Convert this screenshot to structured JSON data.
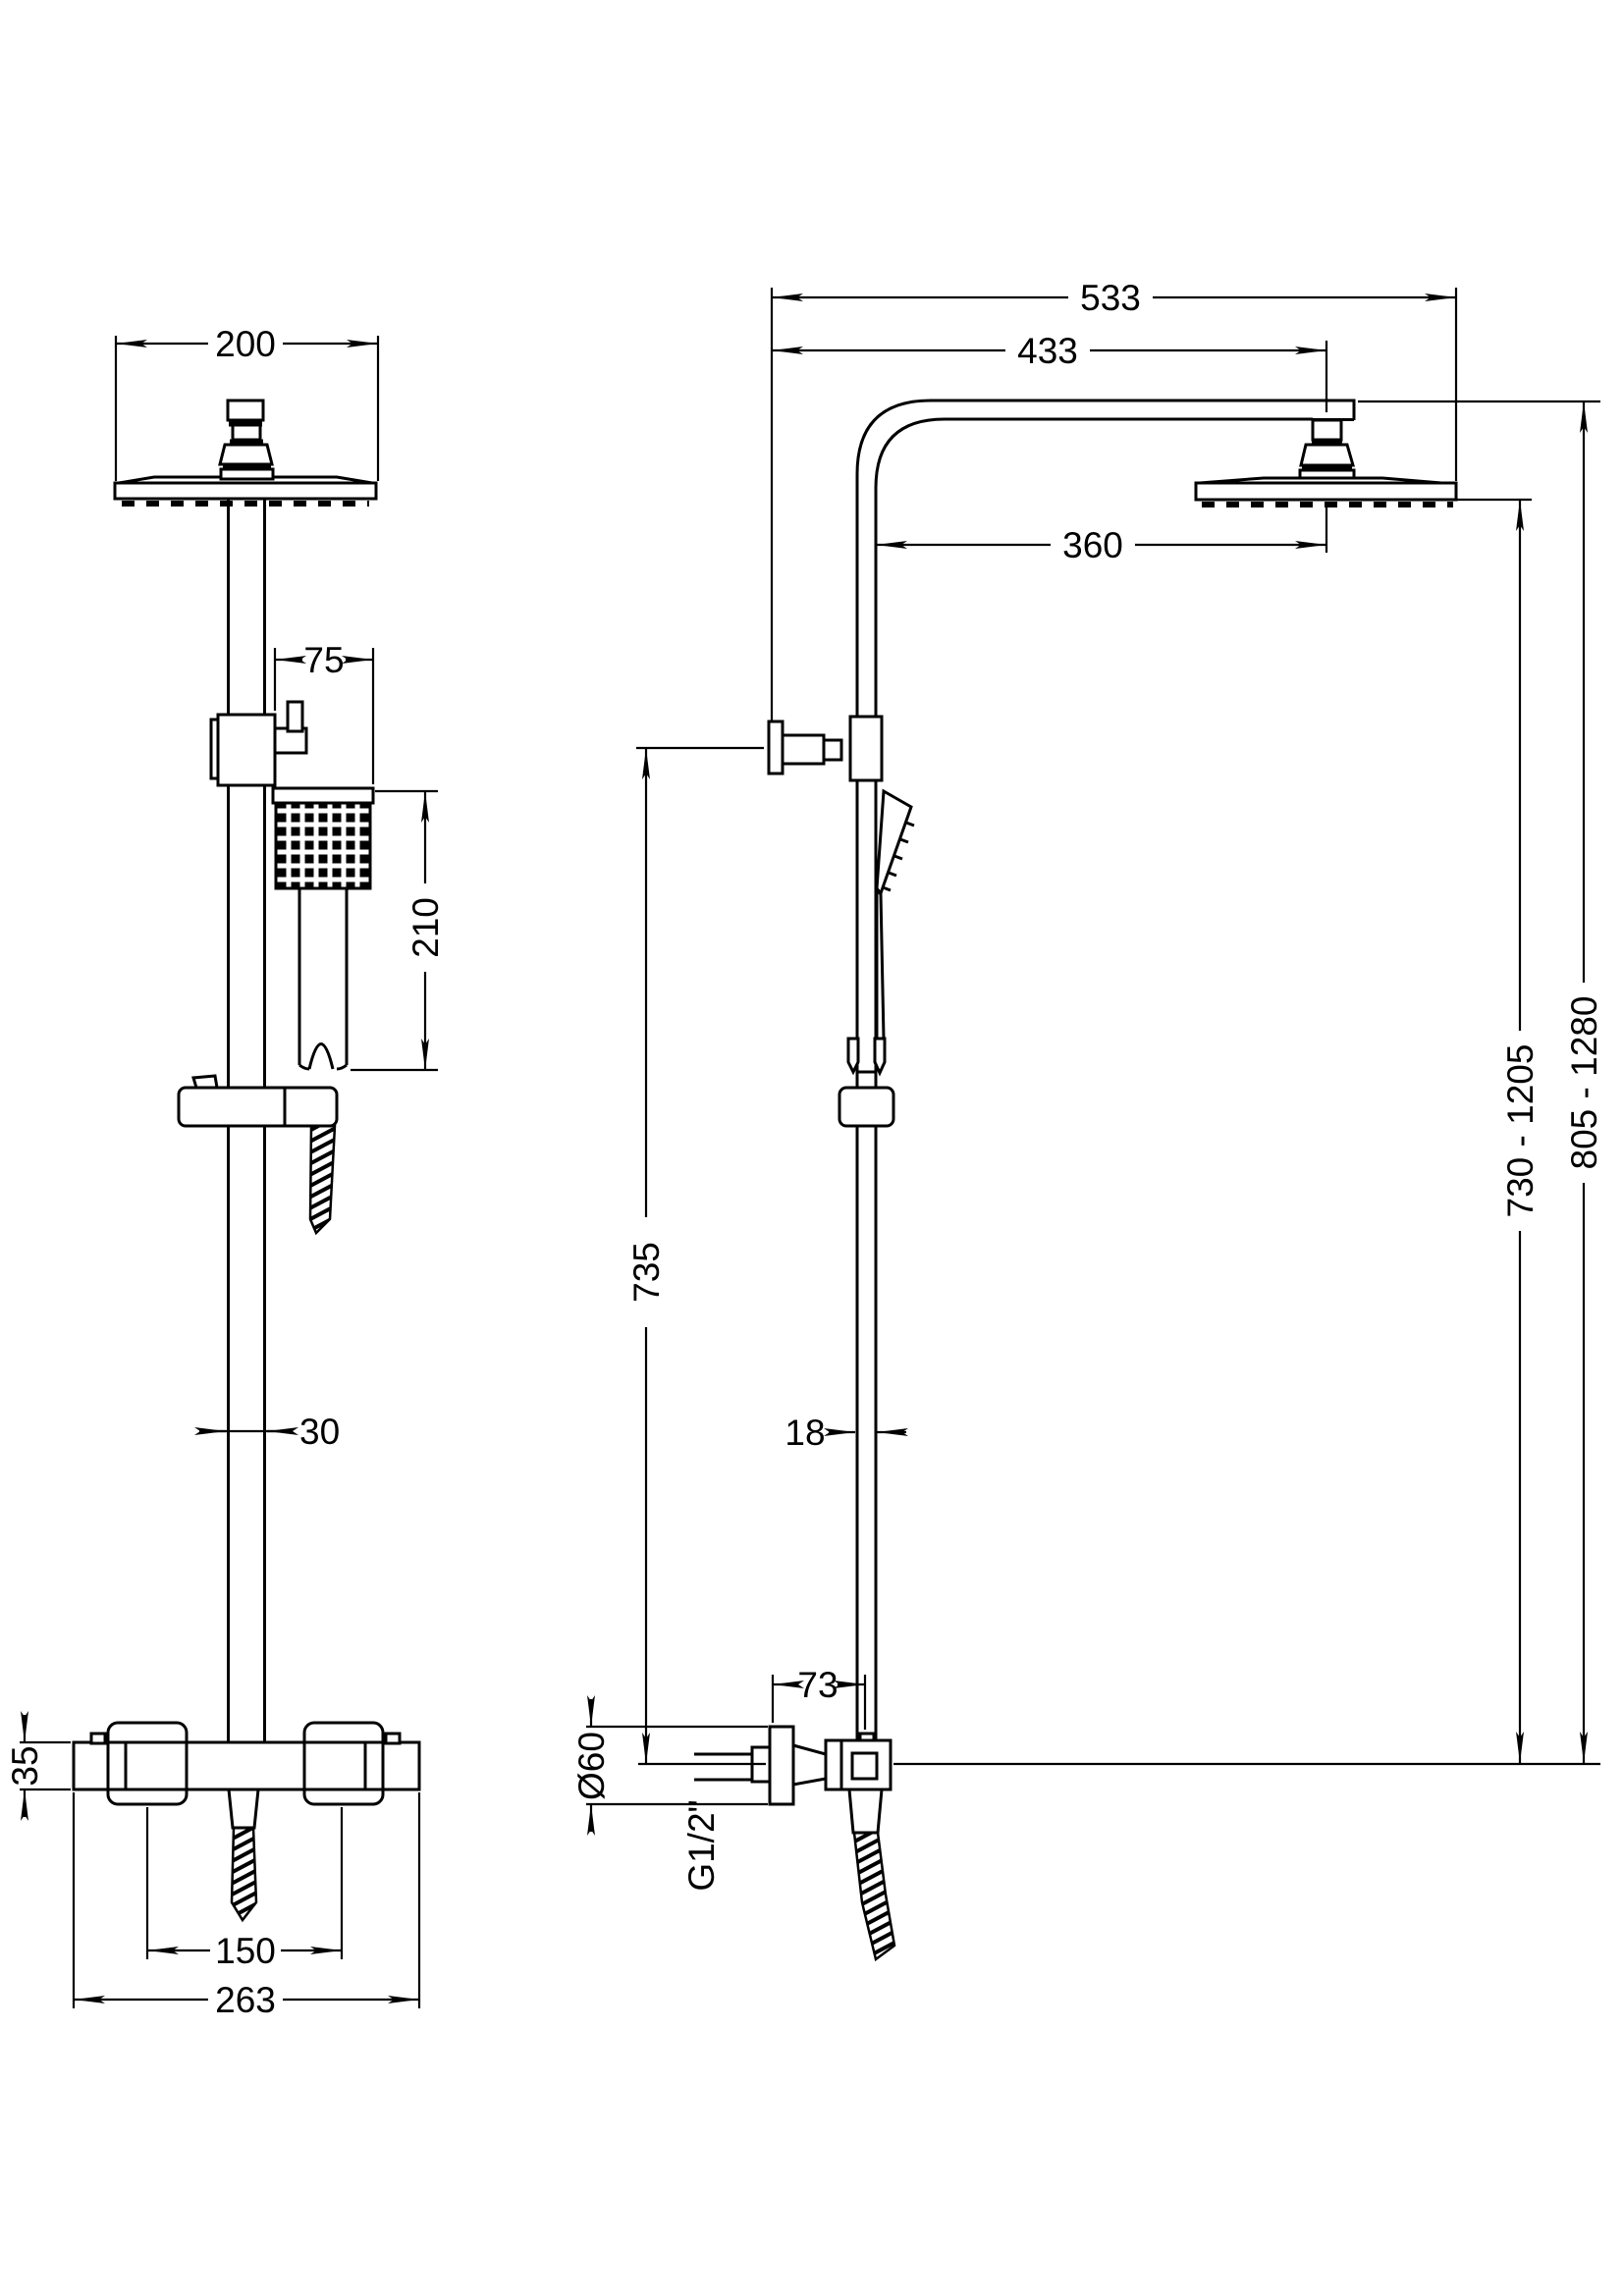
{
  "drawing": {
    "type": "technical-dimension-drawing",
    "subject": "thermostatic shower column with overhead shower, hand shower and bar mixer valve",
    "views": [
      "front elevation",
      "side elevation"
    ],
    "units": "mm",
    "line_color": "#000000",
    "background": "#ffffff"
  },
  "front": {
    "head_width": "200",
    "handset_offset": "75",
    "handset_length": "210",
    "riser_diameter": "30",
    "valve_body_height": "35",
    "inlet_centres": "150",
    "valve_width": "263"
  },
  "side": {
    "overall_projection": "533",
    "arm_projection": "433",
    "head_projection": "360",
    "bracket_to_valve_drop": "735",
    "riser_depth": "18",
    "wall_to_riser": "73",
    "escutcheon_diameter": "Ø60",
    "inlet_connection": "G1/2\"",
    "head_height_range": "730 - 1205",
    "arm_height_range": "805 - 1280"
  }
}
